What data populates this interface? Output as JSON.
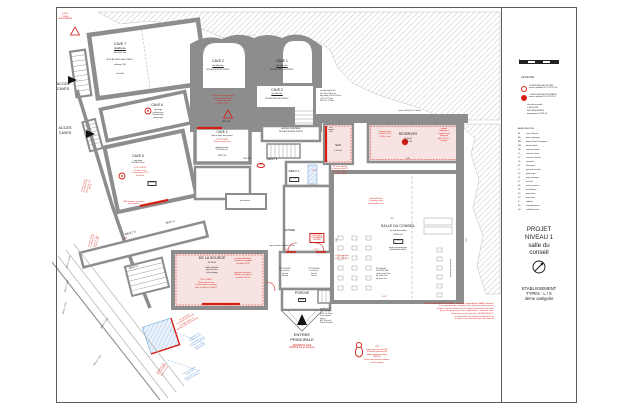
{
  "panel": {
    "legend_title": "LEGENDE",
    "legend_items": [
      {
        "symbol": "risque-moyen-circle",
        "lines": [
          "LOCAUX A RISQUES MOYENS",
          "parois et plafonds CF 1h / PF CF 1/2h"
        ]
      },
      {
        "symbol": "risque-important-circle",
        "lines": [
          "LOCAUX A RISQUES IMPORTANTS",
          "parois et plafonds CF 2h / PF CF 1h"
        ]
      }
    ],
    "securite": [
      "sécurité incendie :",
      "1 SEUL ERP",
      "SSI CATEGORIE E",
      "équipements TYPE 2b"
    ],
    "abbreviations_title": "ABREVIATIONS",
    "abbreviations": [
      {
        "k": "IA",
        "v": "arase inférieure"
      },
      {
        "k": "BA",
        "v": "barre antipanique"
      },
      {
        "k": "BEV",
        "v": "bande d'éveil à la vigilance"
      },
      {
        "k": "BM",
        "v": "bouton moleté"
      },
      {
        "k": "CA",
        "v": "crémone anneau"
      },
      {
        "k": "CL",
        "v": "crémone à levier"
      },
      {
        "k": "CT",
        "v": "crémone à tourner"
      },
      {
        "k": "CF",
        "v": "coupe feu"
      },
      {
        "k": "FP",
        "v": "ferme porte"
      },
      {
        "k": "G",
        "v": "girons de marches"
      },
      {
        "k": "GC",
        "v": "garde corps"
      },
      {
        "k": "GT",
        "v": "gaine technique"
      },
      {
        "k": "M",
        "v": "marches"
      },
      {
        "k": "MC",
        "v": "mains courantes"
      },
      {
        "k": "PF",
        "v": "para flamme"
      },
      {
        "k": "PP",
        "v": "porte pleine"
      },
      {
        "k": "PV",
        "v": "porte vitrée"
      },
      {
        "k": "R",
        "v": "radiateur"
      },
      {
        "k": "VB",
        "v": "ventilation basse"
      },
      {
        "k": "VH",
        "v": "ventilation haute"
      }
    ],
    "scale_ticks": [
      "0",
      "1",
      "2",
      "3",
      "4",
      "5"
    ],
    "project": [
      "PROJET",
      "NIVEAU 1",
      "salle du",
      "conseil"
    ],
    "etablissement": [
      "ETABLISSEMENT",
      "TYPES : L / X",
      "3ème catégorie"
    ]
  },
  "colors": {
    "red": "#d41f17",
    "blue": "#5b8fd6",
    "black": "#1a1a1a",
    "wall": "#8d8d8d",
    "pink": "#f7e3e2"
  },
  "annotations": [
    {
      "n": "alarm-note",
      "t": "le B01\nPOSER\nDES ALARMES",
      "x": 65,
      "y": 13,
      "fs": 2,
      "c": "r"
    },
    {
      "n": "cave7-title",
      "t": "CAVE 7",
      "x": 120,
      "y": 42,
      "fs": 3.6
    },
    {
      "n": "cave7-line1",
      "t": "désaffectée",
      "x": 120,
      "y": 47.5,
      "fs": 2.3,
      "ul": 1
    },
    {
      "n": "cave7-line2",
      "t": "36.00m2 env",
      "x": 120,
      "y": 51.5,
      "fs": 2.2
    },
    {
      "n": "cave7-line3",
      "t": "NON ACCESS. AU PUBLIC",
      "x": 120,
      "y": 59,
      "fs": 2.2
    },
    {
      "n": "cave7-line4",
      "t": "métrage 230",
      "x": 120,
      "y": 64,
      "fs": 2.1
    },
    {
      "n": "cave7-line5",
      "t": "sol sable",
      "x": 120,
      "y": 72.5,
      "fs": 2.1
    },
    {
      "n": "acces-caves-1",
      "t": "ACCES\nCAVES",
      "x": 63,
      "y": 82,
      "fs": 3.8
    },
    {
      "n": "acces-caves-2",
      "t": "ACCES\nCAVES",
      "x": 65,
      "y": 126,
      "fs": 3.8
    },
    {
      "n": "cave2-title",
      "t": "CAVE 2",
      "x": 218,
      "y": 59,
      "fs": 3.4
    },
    {
      "n": "cave2-line1",
      "t": "désaffectée",
      "x": 218,
      "y": 64.5,
      "fs": 2.2,
      "ul": 1
    },
    {
      "n": "cave2-line2",
      "t": "NON ACCESS. AU PUBLIC",
      "x": 218,
      "y": 69,
      "fs": 1.9
    },
    {
      "n": "cave1-title",
      "t": "CAVE 1",
      "x": 282,
      "y": 59,
      "fs": 3.4
    },
    {
      "n": "cave1-line1",
      "t": "désaffectée",
      "x": 282,
      "y": 64.5,
      "fs": 2.2,
      "ul": 1
    },
    {
      "n": "cave1-line2",
      "t": "NON ACCESS. AU PUBLIC",
      "x": 282,
      "y": 69,
      "fs": 1.9
    },
    {
      "n": "cave3-title",
      "t": "CAVE 3",
      "x": 277,
      "y": 88,
      "fs": 3.4
    },
    {
      "n": "cave3-line1",
      "t": "désaffectée",
      "x": 277,
      "y": 93,
      "fs": 2.2,
      "ul": 1
    },
    {
      "n": "cave3-line2",
      "t": "NON ACCESS. AU PUBLIC",
      "x": 277,
      "y": 97.5,
      "fs": 1.9
    },
    {
      "n": "pf-bois-note",
      "t": "PF bois à remplacer par\ncloisonnement CF 1h\n+ trappe de visite\nPF CF 1/2h",
      "x": 223,
      "y": 95,
      "fs": 2.1,
      "c": "r"
    },
    {
      "n": "hsp-190",
      "t": "HSP 190",
      "x": 226,
      "y": 121,
      "fs": 2.1
    },
    {
      "n": "escalier-beton-note",
      "t": "escalier béton 2V\nGC 90 et 93cm ht\nlarg utiles 140 et 102cm\nG 27 à 27.5cm\nM 16 17 à 18cm",
      "x": 320,
      "y": 90,
      "fs": 2,
      "a": "l"
    },
    {
      "n": "cave6-title",
      "t": "CAVE 6",
      "x": 157,
      "y": 103,
      "fs": 3.4
    },
    {
      "n": "cave6-sub",
      "t": "stockage\n(utilisée par\nl'association\nping pong)",
      "x": 158,
      "y": 109,
      "fs": 2.1
    },
    {
      "n": "cave5-title",
      "t": "CAVE 5",
      "x": 138,
      "y": 154,
      "fs": 3.4
    },
    {
      "n": "cave5-sub",
      "t": "stockage\n30.90m2 env",
      "x": 138,
      "y": 159.5,
      "fs": 2.2
    },
    {
      "n": "cave5-red",
      "t": "1 UP 1 DEGT\n75 pers. max\n2 extincteurs CO2\nà prévoir",
      "x": 140,
      "y": 167,
      "fs": 2.1,
      "c": "r"
    },
    {
      "n": "cave5-box",
      "t": "05.29",
      "x": 152,
      "y": 181,
      "fs": 2,
      "b": "k"
    },
    {
      "n": "cave4-title",
      "t": "CAVE 4",
      "x": 222,
      "y": 130,
      "fs": 3.2
    },
    {
      "n": "cave4-sub1",
      "t": "(liée au foyer des jeunes)",
      "x": 222,
      "y": 135,
      "fs": 1.9
    },
    {
      "n": "cave4-red",
      "t": "1 UP 1 DEGT\n19 personnes max",
      "x": 222,
      "y": 138.5,
      "fs": 2.1,
      "c": "r"
    },
    {
      "n": "cave4-sub2",
      "t": "plafond voutés\n20.50m2 env",
      "x": 222,
      "y": 146.5,
      "fs": 2
    },
    {
      "n": "cave4-hsp",
      "t": "HSP 216",
      "x": 222,
      "y": 155,
      "fs": 2
    },
    {
      "n": "cave4-hsp2",
      "t": "HSP 218",
      "x": 247,
      "y": 158,
      "fs": 1.9
    },
    {
      "n": "ancien-cimetiere",
      "t": "ANCIEN CIMETIERE\nNON ACCESS AU PUBLIC",
      "x": 291,
      "y": 128,
      "fs": 2
    },
    {
      "n": "degt2-label",
      "t": "DEGT 2",
      "x": 272,
      "y": 158,
      "fs": 3
    },
    {
      "n": "degt2-oval",
      "t": "040",
      "x": 261,
      "y": 163,
      "fs": 2,
      "c": "r",
      "b": "o"
    },
    {
      "n": "degt1-label",
      "t": "DEGT 1",
      "x": 294,
      "y": 170,
      "fs": 3
    },
    {
      "n": "degt1-level",
      "t": "+1.12",
      "x": 294,
      "y": 177,
      "fs": 2.2,
      "b": "k"
    },
    {
      "n": "degt1-up",
      "t": "2 UP",
      "x": 314,
      "y": 170,
      "fs": 2.1,
      "c": "r"
    },
    {
      "n": "sas-title",
      "t": "SAS",
      "x": 338,
      "y": 144,
      "fs": 2.9
    },
    {
      "n": "sas-sub",
      "t": "5.20 m2",
      "x": 338,
      "y": 149.5,
      "fs": 2.1
    },
    {
      "n": "sas-vmc",
      "t": "vmc\narmoire\nélec",
      "x": 331,
      "y": 127,
      "fs": 1.8
    },
    {
      "n": "reserves-title",
      "t": "RESERVES",
      "x": 408,
      "y": 132,
      "fs": 3.4
    },
    {
      "n": "reserves-sub",
      "t": "25.80m2\nHSP 250",
      "x": 408,
      "y": 138,
      "fs": 2.1
    },
    {
      "n": "reserves-red-left",
      "t": "panneaux bois\nisolation CF 1h\nà 200 à créer",
      "x": 385,
      "y": 131,
      "fs": 1.9,
      "c": "r"
    },
    {
      "n": "reserves-red-right",
      "t": "plafond\nfibralythe à\nremplacer par\nplaque de\nplâtre CF 1h +\nisolation",
      "x": 444,
      "y": 128,
      "fs": 1.9,
      "c": "r"
    },
    {
      "n": "reserves-dim",
      "t": "635",
      "x": 408,
      "y": 158,
      "fs": 2
    },
    {
      "n": "reserves-wall-dim",
      "t": "pierres 100 (h.ht) ± 4 dévers",
      "x": 410,
      "y": 110,
      "fs": 1.8
    },
    {
      "n": "pp-imposte-note",
      "t": "PP avec imposte\nà remplacer par PF\nCF 1/2h + FP et\n1 vantail à 90cm",
      "x": 340,
      "y": 166,
      "fs": 1.9,
      "c": "r"
    },
    {
      "n": "plafond-fibralite-note",
      "t": "plafond fibralite\nà remplacer par\nplafond plâtre bois",
      "x": 376,
      "y": 198,
      "fs": 1.9,
      "c": "r"
    },
    {
      "n": "salle-title",
      "t": "SALLE DU CONSEIL",
      "x": 398,
      "y": 224,
      "fs": 3.6
    },
    {
      "n": "salle-sub1",
      "t": "(ex salle Saussade)",
      "x": 398,
      "y": 229.5,
      "fs": 1.9
    },
    {
      "n": "salle-sub2",
      "t": "103.00 m2",
      "x": 398,
      "y": 233.5,
      "fs": 2.1
    },
    {
      "n": "salle-level",
      "t": "+1.12",
      "x": 398,
      "y": 239,
      "fs": 2.2,
      "b": "k"
    },
    {
      "n": "salle-sub3",
      "t": "parois panneaux bois\nplafond dalle 60x60",
      "x": 398,
      "y": 246.5,
      "fs": 1.9
    },
    {
      "n": "salle-dim-top",
      "t": "957",
      "x": 392,
      "y": 218,
      "fs": 1.9
    },
    {
      "n": "pv-equiper-note",
      "t": "4 PV à équiper\net BP OUVERT",
      "x": 342,
      "y": 255,
      "fs": 2,
      "c": "r"
    },
    {
      "n": "pp-door-spec",
      "t": "PP 1Vantail\n151x220h, BM\nseuil ressaut 3cm\nép. porte 5cm\nép. para 5cm",
      "x": 376,
      "y": 268,
      "fs": 1.9,
      "a": "l"
    },
    {
      "n": "salle-parois-rot",
      "t": "parois panneaux bois",
      "x": 450,
      "y": 268,
      "fs": 1.9,
      "rot": -90
    },
    {
      "n": "salle-dim-right",
      "t": "1117",
      "x": 466,
      "y": 240,
      "fs": 1.9,
      "rot": -90
    },
    {
      "n": "salle-dim-left",
      "t": "608",
      "x": 336,
      "y": 240,
      "fs": 1.9,
      "rot": -90
    },
    {
      "n": "source-title",
      "t": "DE LA SOURCE",
      "x": 212,
      "y": 256,
      "fs": 3.6
    },
    {
      "n": "source-sub1",
      "t": "32.90m2",
      "x": 212,
      "y": 262,
      "fs": 2.2
    },
    {
      "n": "source-sub2",
      "t": "HSPs plaf 244\nplénum 16cm\nsol carrelage",
      "x": 212,
      "y": 266.5,
      "fs": 2
    },
    {
      "n": "source-red-center",
      "t": "1 UP 1 DEGT\n19 personnes max\n(si nécessaire une porte\nentre la salle et le DEGT)",
      "x": 206,
      "y": 279,
      "fs": 2,
      "c": "r"
    },
    {
      "n": "source-red-right1",
      "t": "panneaux fibralythe\nà recouvrir par plaque\nde plâtre CF 2h",
      "x": 243,
      "y": 258,
      "fs": 1.9,
      "c": "r"
    },
    {
      "n": "source-red-right2",
      "t": "plancher haut bois à\ndoubler avec plaque\nde plâtre CF 1/2h",
      "x": 243,
      "y": 272,
      "fs": 1.9,
      "c": "r"
    },
    {
      "n": "porche-label",
      "t": "PORCHE",
      "x": 302,
      "y": 291,
      "fs": 3.4
    },
    {
      "n": "porche-level",
      "t": "0.00",
      "x": 302,
      "y": 297.5,
      "fs": 2,
      "b": "k"
    },
    {
      "n": "escalier-1vt-note",
      "t": "escalier 1 Vt\nG 27 à 29cm\nM 14.5 à 16cm\nSans marche\nhaute\nMC 102cm ht\n110cm franchis.",
      "x": 320,
      "y": 308,
      "fs": 1.9,
      "a": "l"
    },
    {
      "n": "entree-int",
      "t": "ENTREE",
      "x": 290,
      "y": 228.5,
      "fs": 2.5
    },
    {
      "n": "centrale-desenf",
      "t": "CENTRALE\nCOMMANDE\nDESENF.",
      "x": 317,
      "y": 233,
      "fs": 1.9,
      "c": "r",
      "b": "r"
    },
    {
      "n": "tapis-note",
      "t": "tapis encastré dévaloir - 1.5m",
      "x": 282,
      "y": 245,
      "fs": 1.9
    },
    {
      "n": "machinerie-label",
      "t": "machinerie",
      "x": 245,
      "y": 199.5,
      "fs": 2.1
    },
    {
      "n": "pv-door-1",
      "t": "PV 150x220h\nva et vient\nép 5cm\nserrure",
      "x": 285,
      "y": 268,
      "fs": 1.9
    },
    {
      "n": "pv-door-2",
      "t": "PV 150x220h\nva et vient\nép 5cm\nserrure",
      "x": 314,
      "y": 268,
      "fs": 1.9
    },
    {
      "n": "up-door-1",
      "t": "2 UP",
      "x": 286,
      "y": 249,
      "fs": 2.1,
      "c": "r"
    },
    {
      "n": "up-door-2",
      "t": "2 UP",
      "x": 316,
      "y": 249,
      "fs": 2.1,
      "c": "r"
    },
    {
      "n": "up-degt3",
      "t": "2 UP",
      "x": 125,
      "y": 238,
      "fs": 2.1,
      "c": "r",
      "rot": -14
    },
    {
      "n": "up-stair",
      "t": "1 UP",
      "x": 384,
      "y": 295.5,
      "fs": 2.1,
      "c": "r"
    },
    {
      "n": "entree-principale",
      "t": "ENTREE\nPRINCIPALE",
      "x": 302,
      "y": 332,
      "fs": 4
    },
    {
      "n": "desserte-voie",
      "t": "DESSERTE VOIE\nENGINS rue de barreyre",
      "x": 302,
      "y": 344.5,
      "fs": 2.3,
      "c": "r"
    },
    {
      "n": "pei-note",
      "t": "PEI\npoteau incendie de 100\n130m3/H pendant 2H\ndébit minimum unitaire\n60M3/H\n8 bars de pression statique\nrue du jardinet",
      "x": 377,
      "y": 346,
      "fs": 2.1,
      "c": "r"
    },
    {
      "n": "niveau-note",
      "t": "SUR L'ENSEMBLE DU NIVEAU : ressaisie l'ensemble des BAES existants,\nle recoupement des conduits et les traversées des réseaux.\nHauteur entre le niveau bas et le plancher bas du niveau haut\n(hors salle ping pong accès indépendant) : inférieure à 8m.\nExtincteurs et plan sécurité : HORS PROJET :\nla localisation des extincteurs existants sur\nles plans n'est seulement qu'à titre indicatif",
      "x": 494,
      "y": 302.5,
      "fs": 2.1,
      "c": "r",
      "a": "r"
    },
    {
      "n": "degt5-label",
      "t": "DEGT 5",
      "x": 170,
      "y": 221,
      "fs": 2.6,
      "rot": -12
    },
    {
      "n": "degt3-label",
      "t": "DEGT 3",
      "x": 130,
      "y": 232,
      "fs": 3,
      "rot": -14
    },
    {
      "n": "degt4-label",
      "t": "DEGT 4",
      "x": 133,
      "y": 266,
      "fs": 2.6,
      "rot": -14
    },
    {
      "n": "dim-ramp-1",
      "t": "365cm / 7.63%",
      "x": 68,
      "y": 262,
      "fs": 1.9,
      "rot": -75
    },
    {
      "n": "dim-ramp-2",
      "t": "346cm / 7.63%",
      "x": 66,
      "y": 286,
      "fs": 1.9,
      "rot": -75
    },
    {
      "n": "dim-ramp-3",
      "t": "340cm / 7.63%",
      "x": 64,
      "y": 308,
      "fs": 1.9,
      "rot": -75
    },
    {
      "n": "dim-ramp-4",
      "t": "346cm / 7.63%",
      "x": 104,
      "y": 323,
      "fs": 1.9,
      "rot": -55
    },
    {
      "n": "dim-ramp-5",
      "t": "365cm / 7.63%",
      "x": 97,
      "y": 360,
      "fs": 1.9,
      "rot": -55
    },
    {
      "n": "pp-left-1",
      "t": "PP bois 73x210\nà remplacer par\nPORTE CF 1/2h\n+ FP, CL",
      "x": 83,
      "y": 185,
      "fs": 1.9,
      "c": "r",
      "rot": -75
    },
    {
      "n": "pp-left-2",
      "t": "PF bois 73x210\nà remplacer par\nporte CF 1/2h\n+ FP, CL, BM",
      "x": 90,
      "y": 240,
      "fs": 1.9,
      "c": "r",
      "rot": -75
    },
    {
      "n": "bev-cave5",
      "t": "BEV à prévoir au dessus\nde la marche",
      "x": 134,
      "y": 201,
      "fs": 1.9,
      "c": "r"
    },
    {
      "n": "pv-remplacer-note",
      "t": "PV 150x220h\nà remplacer par PV dont\n1 vantail à 90cm, CL\nbandeau 10%, seuil franchiss.",
      "x": 184,
      "y": 317,
      "fs": 1.9,
      "c": "r",
      "rot": -30
    },
    {
      "n": "derogation-note",
      "t": "DEMANDE DE\nDEROGATION\nmarches extérieures\n2 cotes sur existant\npente à 10%\nallées inclus",
      "x": 194,
      "y": 336,
      "fs": 1.9,
      "c": "u",
      "rot": -30
    },
    {
      "n": "candelabre-note",
      "t": "Futur candélabre\nsolaire LED\nhauteur d'environ 4m\nimplanté extérieur",
      "x": 189,
      "y": 370,
      "fs": 1.9,
      "c": "u",
      "rot": -30
    },
    {
      "n": "dessous-note",
      "t": "DESSOUS DE\nTOIT à POSER\ndessin 76 env",
      "x": 160,
      "y": 368,
      "fs": 1.9,
      "c": "r",
      "rot": -55
    }
  ]
}
